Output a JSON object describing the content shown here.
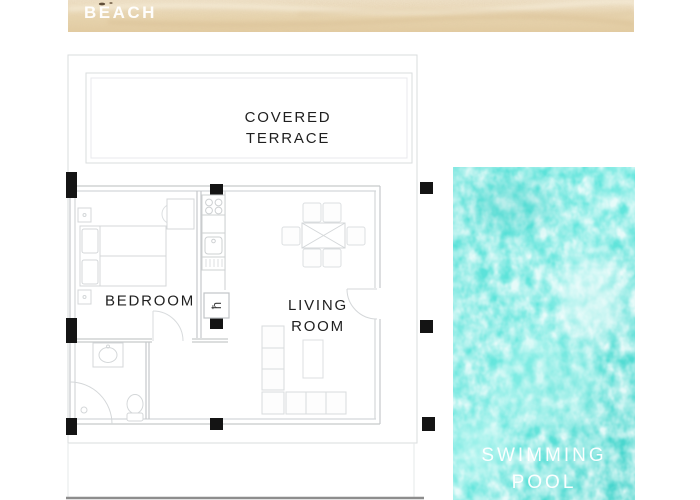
{
  "banner": {
    "label": "BEACH"
  },
  "floor_plan": {
    "terrace_label": "COVERED TERRACE",
    "bedroom_label": "BEDROOM",
    "living_room_label": "LIVING ROOM",
    "water_heater_symbol": "ħ"
  },
  "pool": {
    "label": "SWIMMING POOL"
  },
  "colors": {
    "sand": "#e8d6b4",
    "water": "#4fdbd2",
    "wall_line": "#c6c9cb",
    "furniture_line": "#d8dbdd",
    "column": "#141414",
    "label_text": "#1f1f1f",
    "banner_text": "#ffffff"
  }
}
